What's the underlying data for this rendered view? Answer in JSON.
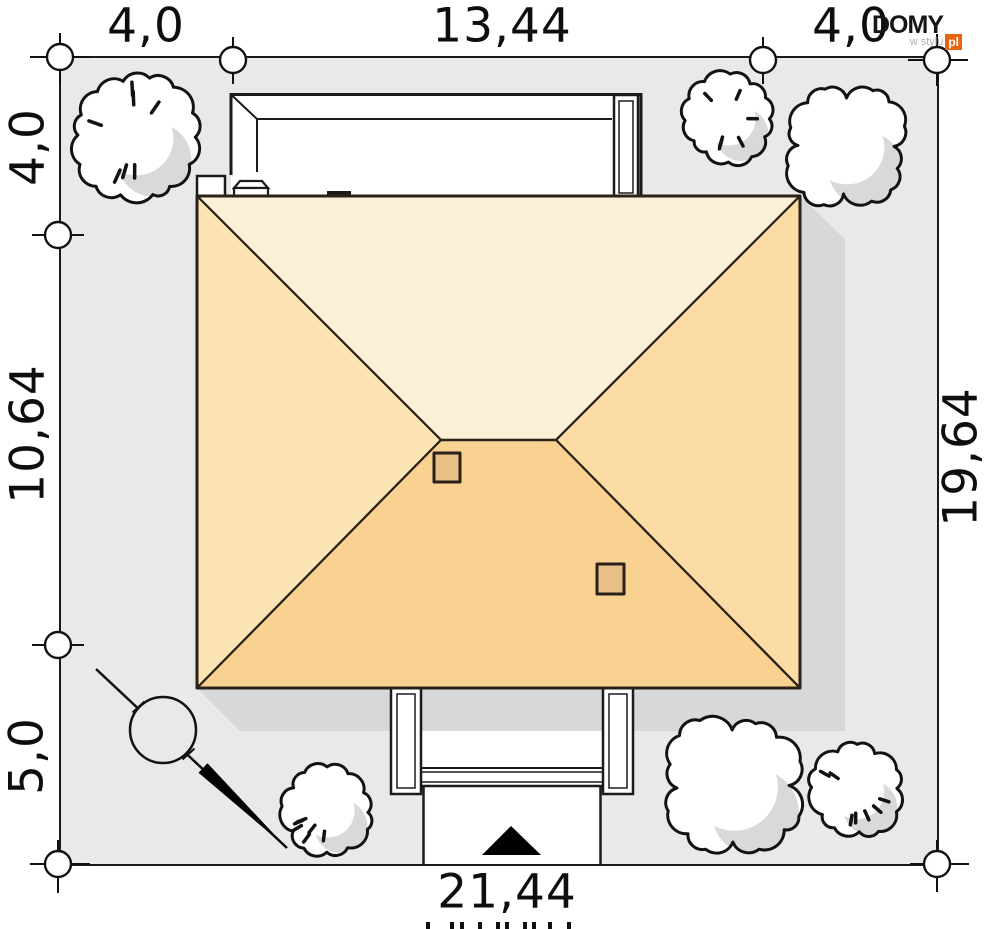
{
  "dims": {
    "top_left": "4,0",
    "top_mid": "13,44",
    "top_right": "4,0",
    "left_top": "4,0",
    "left_mid": "10,64",
    "left_bottom": "5,0",
    "right": "19,64",
    "bottom": "21,44"
  },
  "logo": {
    "brand": "DOMY",
    "tagline": "w stylu",
    "suffix": "pl"
  },
  "colors": {
    "plot_fill": "#E9E9E9",
    "shadow": "#D8D8D8",
    "roof_top_slope": "#FBF0D6",
    "roof_left_slope": "#FCE4B4",
    "roof_right_slope": "#FADCA4",
    "roof_bottom_slope": "#F9D291",
    "chimney_fill": "#E7C088",
    "line": "#1B1B1B",
    "logo_accent": "#E8640F"
  },
  "symbols": {
    "trees": [
      "bush",
      "bush",
      "tree",
      "bush",
      "tree",
      "bush"
    ],
    "deciduous_tree_marker": "circle-with-diagonal-and-wedge",
    "entrance_arrow": "black-triangle",
    "dimension_marker": "circle-on-boundary"
  }
}
